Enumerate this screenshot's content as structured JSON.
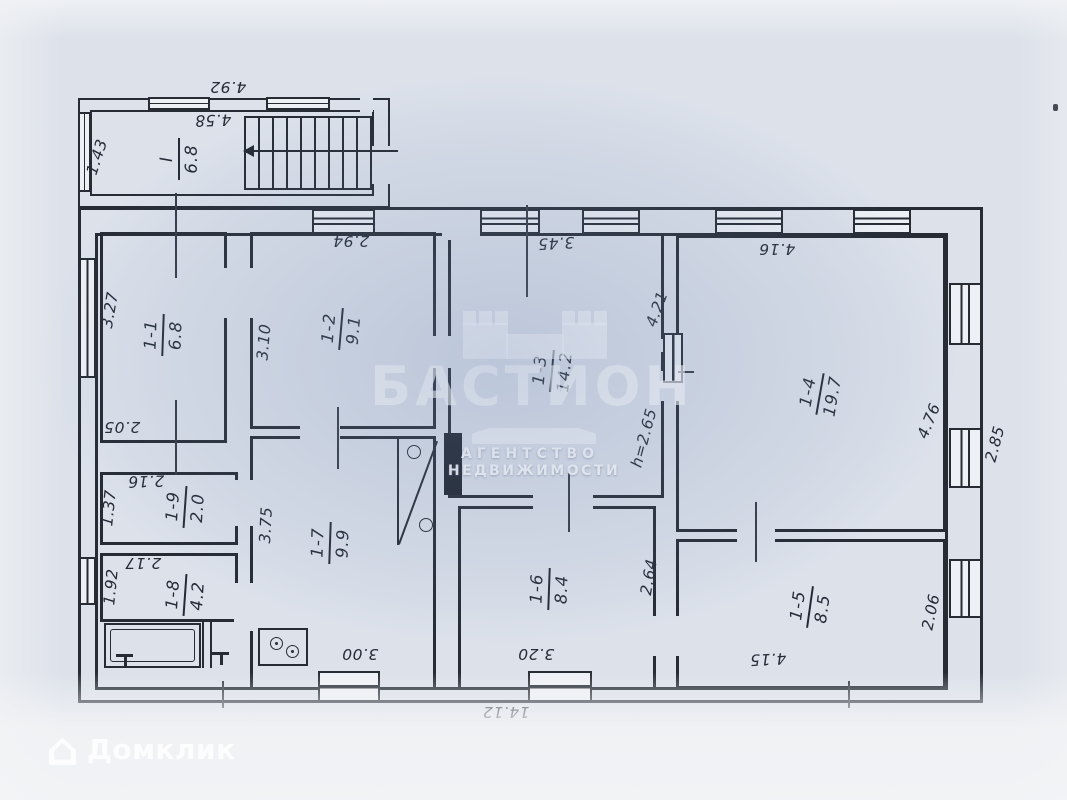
{
  "colors": {
    "paper": "#dce1ea",
    "ink": "#262b34",
    "handwriting": "#242b37",
    "watermark_white": "#ffffff",
    "center_tint": "#c9d2e2"
  },
  "watermark": {
    "brand": "БАСТИОН",
    "tagline1": "АГЕНТСТВО",
    "tagline2": "НЕДВИЖИМОСТИ"
  },
  "footer": {
    "logo_text": "Домклик"
  },
  "plan": {
    "rooms": [
      {
        "name": "I",
        "area": "6.8",
        "x": 179,
        "y": 159,
        "rot": -90
      },
      {
        "name": "1-1",
        "area": "6.8",
        "x": 163,
        "y": 335,
        "rot": -88
      },
      {
        "name": "1-2",
        "area": "9.1",
        "x": 341,
        "y": 329,
        "rot": -85
      },
      {
        "name": "1-3",
        "area": "14.2",
        "x": 552,
        "y": 371,
        "rot": -85
      },
      {
        "name": "1-4",
        "area": "19.7",
        "x": 820,
        "y": 394,
        "rot": -80
      },
      {
        "name": "1-5",
        "area": "8.5",
        "x": 810,
        "y": 607,
        "rot": -82
      },
      {
        "name": "1-6",
        "area": "8.4",
        "x": 549,
        "y": 589,
        "rot": -88
      },
      {
        "name": "1-7",
        "area": "9.9",
        "x": 330,
        "y": 543,
        "rot": -88
      },
      {
        "name": "1-8",
        "area": "4.2",
        "x": 185,
        "y": 595,
        "rot": -86
      },
      {
        "name": "1-9",
        "area": "2.0",
        "x": 185,
        "y": 507,
        "rot": -86
      }
    ],
    "dims": [
      {
        "text": "4.92",
        "x": 228,
        "y": 87,
        "rot": 180
      },
      {
        "text": "4.58",
        "x": 213,
        "y": 120,
        "rot": 178
      },
      {
        "text": "1.43",
        "x": 97,
        "y": 157,
        "rot": -72
      },
      {
        "text": "2.94",
        "x": 351,
        "y": 241,
        "rot": 180
      },
      {
        "text": "3.45",
        "x": 556,
        "y": 243,
        "rot": 177
      },
      {
        "text": "4.16",
        "x": 777,
        "y": 249,
        "rot": 180
      },
      {
        "text": "3.27",
        "x": 110,
        "y": 310,
        "rot": -80
      },
      {
        "text": "3.10",
        "x": 264,
        "y": 342,
        "rot": -85
      },
      {
        "text": "4.21",
        "x": 657,
        "y": 309,
        "rot": -70
      },
      {
        "text": "h=2.65",
        "x": 644,
        "y": 438,
        "rot": -75
      },
      {
        "text": "4.76",
        "x": 929,
        "y": 421,
        "rot": -68
      },
      {
        "text": "2.85",
        "x": 995,
        "y": 444,
        "rot": -75
      },
      {
        "text": "2.05",
        "x": 122,
        "y": 427,
        "rot": 180
      },
      {
        "text": "2.16",
        "x": 146,
        "y": 481,
        "rot": 178
      },
      {
        "text": "1.37",
        "x": 109,
        "y": 508,
        "rot": -84
      },
      {
        "text": "2.17",
        "x": 143,
        "y": 563,
        "rot": 180
      },
      {
        "text": "1.92",
        "x": 111,
        "y": 587,
        "rot": -84
      },
      {
        "text": "3.75",
        "x": 266,
        "y": 525,
        "rot": -87
      },
      {
        "text": "2.64",
        "x": 649,
        "y": 577,
        "rot": -80
      },
      {
        "text": "2.06",
        "x": 931,
        "y": 612,
        "rot": -78
      },
      {
        "text": "3.00",
        "x": 360,
        "y": 654,
        "rot": 180
      },
      {
        "text": "3.20",
        "x": 536,
        "y": 654,
        "rot": 180
      },
      {
        "text": "4.15",
        "x": 768,
        "y": 659,
        "rot": 177
      },
      {
        "text": "14.12",
        "x": 506,
        "y": 712,
        "rot": 180
      }
    ]
  }
}
